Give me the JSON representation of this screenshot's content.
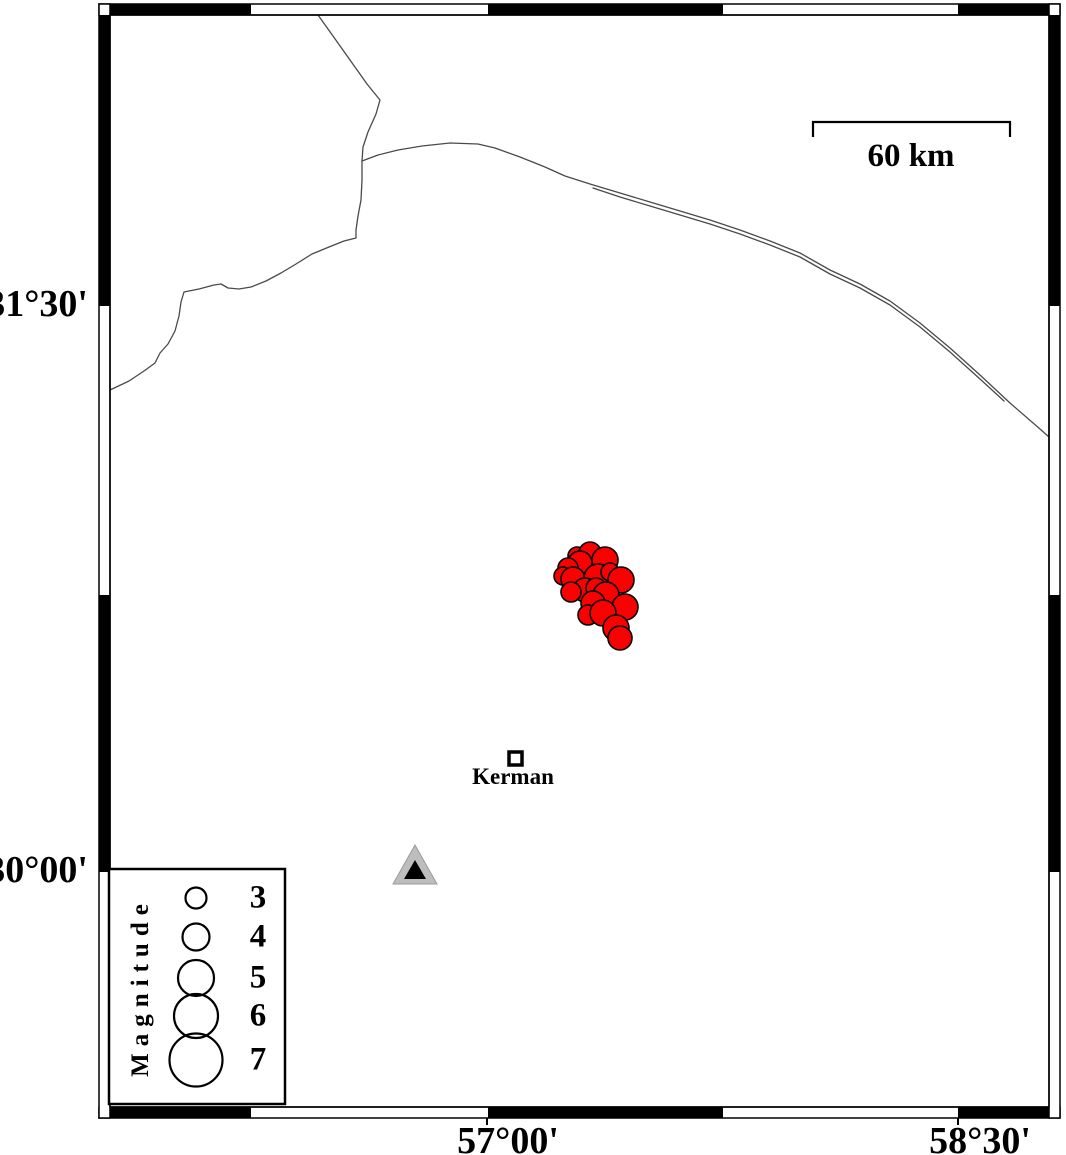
{
  "colors": {
    "background": "#ffffff",
    "frame_black": "#000000",
    "road": "#4a4a4a",
    "earthquake_fill": "#fa0000",
    "earthquake_stroke": "#000000",
    "station_fill": "#bdbdbd",
    "station_edge": "#9a9a9a",
    "station_inner": "#000000",
    "text": "#000000"
  },
  "axes": {
    "lat_ticks": [
      {
        "label": "31°30'",
        "y": 306
      },
      {
        "label": "30°00'",
        "y": 872
      }
    ],
    "lon_ticks": [
      {
        "label": "57°00'",
        "tick_x": 487,
        "label_cx": 508
      },
      {
        "label": "58°30'",
        "tick_x": 958,
        "label_cx": 980
      }
    ]
  },
  "frame": {
    "outer": {
      "x": 99,
      "y": 4,
      "w": 961,
      "h": 1114
    },
    "thickness": 11,
    "x_bounds": [
      110,
      251,
      488,
      723,
      958,
      1049
    ],
    "y_bounds": [
      15,
      306,
      595,
      872,
      1107
    ]
  },
  "scale_bar": {
    "label": "60 km",
    "x1": 813,
    "x2": 1010,
    "y": 122,
    "tick_drop": 15,
    "label_cx": 911,
    "label_top": 138
  },
  "city": {
    "name": "Kerman",
    "marker": {
      "x": 509,
      "y": 752,
      "size": 13
    },
    "label_cx": 513,
    "label_top": 764
  },
  "station": {
    "outer": [
      [
        415,
        845
      ],
      [
        393,
        884
      ],
      [
        437,
        884
      ]
    ],
    "inner": [
      [
        415,
        860
      ],
      [
        404,
        879
      ],
      [
        426,
        879
      ]
    ]
  },
  "legend": {
    "title": "Magnitude",
    "box": {
      "x": 109,
      "y": 869,
      "w": 176,
      "h": 235
    },
    "circle_cx": 196,
    "label_cx": 258,
    "entries": [
      {
        "label": "3",
        "radius": 10.5,
        "cy": 898
      },
      {
        "label": "4",
        "radius": 13.5,
        "cy": 937
      },
      {
        "label": "5",
        "radius": 18,
        "cy": 978
      },
      {
        "label": "6",
        "radius": 22,
        "cy": 1016
      },
      {
        "label": "7",
        "radius": 26.5,
        "cy": 1060
      }
    ]
  },
  "earthquakes": [
    {
      "x": 577,
      "y": 556,
      "r": 9
    },
    {
      "x": 590,
      "y": 553,
      "r": 11
    },
    {
      "x": 605,
      "y": 560,
      "r": 13
    },
    {
      "x": 580,
      "y": 563,
      "r": 12
    },
    {
      "x": 568,
      "y": 568,
      "r": 10
    },
    {
      "x": 563,
      "y": 576,
      "r": 9
    },
    {
      "x": 573,
      "y": 579,
      "r": 12
    },
    {
      "x": 598,
      "y": 578,
      "r": 14
    },
    {
      "x": 610,
      "y": 572,
      "r": 9
    },
    {
      "x": 621,
      "y": 580,
      "r": 13
    },
    {
      "x": 585,
      "y": 590,
      "r": 12
    },
    {
      "x": 571,
      "y": 592,
      "r": 10
    },
    {
      "x": 596,
      "y": 588,
      "r": 10
    },
    {
      "x": 606,
      "y": 595,
      "r": 13
    },
    {
      "x": 593,
      "y": 603,
      "r": 12
    },
    {
      "x": 625,
      "y": 607,
      "r": 13
    },
    {
      "x": 588,
      "y": 615,
      "r": 10
    },
    {
      "x": 603,
      "y": 613,
      "r": 13
    },
    {
      "x": 616,
      "y": 628,
      "r": 13
    },
    {
      "x": 620,
      "y": 638,
      "r": 12
    }
  ],
  "roads": [
    {
      "name": "road-north",
      "points": [
        [
          318,
          15
        ],
        [
          333,
          36
        ],
        [
          350,
          60
        ],
        [
          367,
          84
        ],
        [
          380,
          100
        ],
        [
          376,
          114
        ],
        [
          368,
          132
        ],
        [
          363,
          147
        ],
        [
          362,
          161
        ]
      ]
    },
    {
      "name": "road-east",
      "points": [
        [
          362,
          161
        ],
        [
          378,
          155
        ],
        [
          398,
          150
        ],
        [
          422,
          146
        ],
        [
          450,
          143
        ],
        [
          478,
          144
        ],
        [
          495,
          148
        ],
        [
          520,
          157
        ],
        [
          545,
          167
        ],
        [
          565,
          176
        ],
        [
          590,
          184
        ],
        [
          620,
          193
        ],
        [
          650,
          202
        ],
        [
          680,
          211
        ],
        [
          710,
          220
        ],
        [
          740,
          230
        ],
        [
          770,
          241
        ],
        [
          800,
          253
        ],
        [
          830,
          270
        ],
        [
          860,
          284
        ],
        [
          890,
          301
        ],
        [
          920,
          323
        ],
        [
          950,
          348
        ],
        [
          980,
          375
        ],
        [
          1010,
          403
        ],
        [
          1040,
          429
        ],
        [
          1049,
          437
        ]
      ]
    },
    {
      "name": "road-east-parallel",
      "points": [
        [
          593,
          188
        ],
        [
          620,
          197
        ],
        [
          650,
          206
        ],
        [
          680,
          215
        ],
        [
          710,
          224
        ],
        [
          740,
          234
        ],
        [
          770,
          245
        ],
        [
          800,
          257
        ],
        [
          830,
          274
        ],
        [
          860,
          288
        ],
        [
          890,
          305
        ],
        [
          920,
          327
        ],
        [
          950,
          352
        ],
        [
          980,
          379
        ],
        [
          1004,
          401
        ]
      ]
    },
    {
      "name": "road-southwest",
      "points": [
        [
          362,
          161
        ],
        [
          362,
          180
        ],
        [
          361,
          200
        ],
        [
          358,
          216
        ],
        [
          356,
          230
        ],
        [
          356,
          238
        ],
        [
          344,
          241
        ],
        [
          329,
          247
        ],
        [
          312,
          254
        ],
        [
          296,
          264
        ],
        [
          281,
          273
        ],
        [
          266,
          281
        ],
        [
          251,
          287
        ],
        [
          239,
          289
        ],
        [
          228,
          288
        ],
        [
          221,
          284
        ],
        [
          214,
          285
        ],
        [
          199,
          289
        ],
        [
          184,
          292
        ],
        [
          181,
          302
        ],
        [
          179,
          316
        ],
        [
          175,
          331
        ],
        [
          168,
          344
        ],
        [
          160,
          353
        ],
        [
          155,
          363
        ],
        [
          144,
          371
        ],
        [
          129,
          381
        ],
        [
          110,
          390
        ]
      ]
    }
  ]
}
